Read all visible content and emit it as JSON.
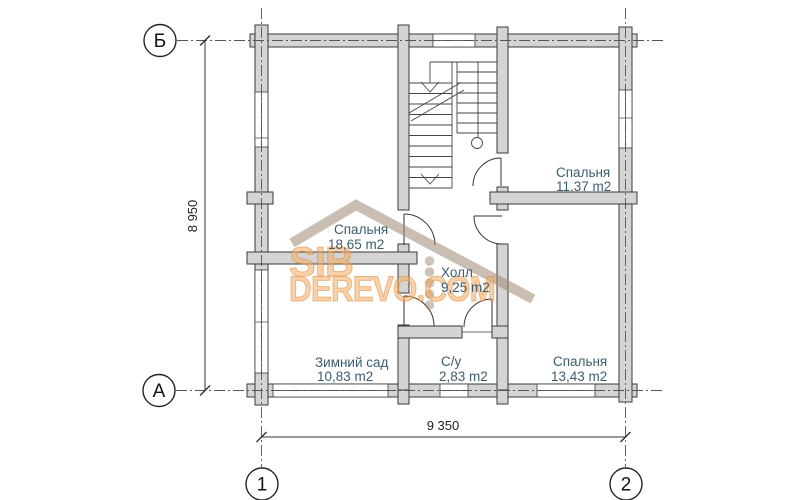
{
  "plan": {
    "rooms": [
      {
        "id": "bedroom-1865",
        "name": "Спальня",
        "area": "18,65 m2"
      },
      {
        "id": "bedroom-1137",
        "name": "Спальня",
        "area": "11,37 m2"
      },
      {
        "id": "hall",
        "name": "Холл",
        "area": "9,25 m2"
      },
      {
        "id": "winter-garden",
        "name": "Зимний сад",
        "area": "10,83 m2"
      },
      {
        "id": "bathroom",
        "name": "С/у",
        "area": "2,83 m2"
      },
      {
        "id": "bedroom-1343",
        "name": "Спальня",
        "area": "13,43 m2"
      }
    ],
    "grid": {
      "row_top": "Б",
      "row_bottom": "А",
      "col_left": "1",
      "col_right": "2"
    },
    "dimensions": {
      "vertical": "8 950",
      "horizontal": "9 350"
    },
    "watermark": {
      "line1": "SIB",
      "line2": "DEREVO.COM"
    },
    "colors": {
      "wall_fill": "#d4d4d4",
      "room_label": "#3c5d70",
      "watermark_orange": "#f4ac60",
      "watermark_roof": "#9e8874"
    }
  }
}
